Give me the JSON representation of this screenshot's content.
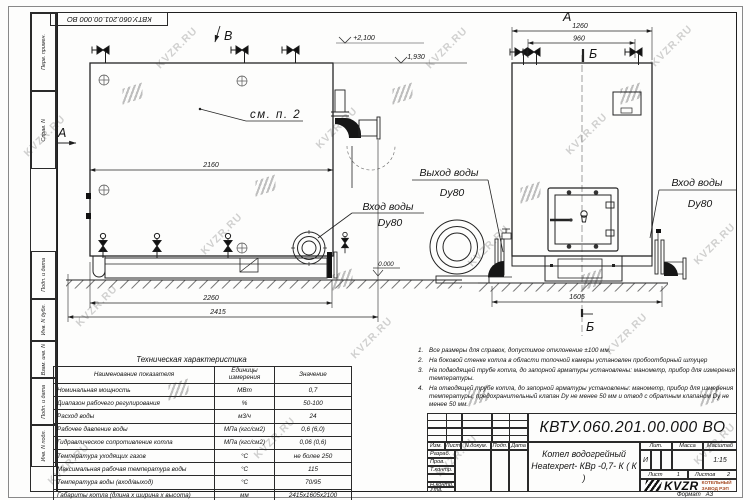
{
  "watermark": {
    "text": "KVZR.RU"
  },
  "frame": {
    "corner_designation": "КВТУ.060.201.00.000  ВО",
    "left_strip": [
      "Перв. примен.",
      "Справ. N",
      "Подп. и дата",
      "Инв. N дубл.",
      "Взам. инв. N",
      "Подп. и дата",
      "Инв. N подл."
    ]
  },
  "drawing": {
    "view_labels": {
      "a": "А",
      "b": "Б",
      "v": "В"
    },
    "callout_see_item": "см. п. 2",
    "levels": {
      "top": "+2,100",
      "middle": "1,930",
      "zero": "0.000"
    },
    "dims": {
      "body_width": "2160",
      "base_width": "2260",
      "total_width": "2415",
      "front_width": "1260",
      "valve_spacing": "960",
      "front_depth": "1605"
    },
    "ports": {
      "inlet": "Вход воды",
      "outlet": "Выход воды",
      "dn": "Dy80"
    }
  },
  "tech_table": {
    "title": "Техническая характеристика",
    "headers": [
      "Наименование показателя",
      "Единицы измерения",
      "Значение"
    ],
    "rows": [
      [
        "Номинальная мощность",
        "МВт",
        "0,7"
      ],
      [
        "Диапазон рабочего регулирования",
        "%",
        "50-100"
      ],
      [
        "Расход воды",
        "м3/ч",
        "24"
      ],
      [
        "Рабочее давление воды",
        "МПа (кгс/см2)",
        "0,6 (6,0)"
      ],
      [
        "Гидравлическое сопротивление котла",
        "МПа (кгс/см2)",
        "0,06 (0,6)"
      ],
      [
        "Температура уходящих газов",
        "°С",
        "не более 250"
      ],
      [
        "Максимальная рабочая температура воды",
        "°С",
        "115"
      ],
      [
        "Температура воды (вход/выход)",
        "°С",
        "70/95"
      ],
      [
        "Габариты котла (длина х ширина х высота)",
        "мм",
        "2415х1605х2100"
      ]
    ]
  },
  "notes": {
    "items": [
      {
        "num": "1.",
        "text": "Все размеры для справок, допустимое отклонение  ±100 мм."
      },
      {
        "num": "2.",
        "text": "На боковой стенке котла в области топочной камеры установлен пробоотборный штуцер"
      },
      {
        "num": "3.",
        "text": "На  подводящей трубе котла, до запорной арматуры установлены: манометр, прибор для измерения температуры."
      },
      {
        "num": "4.",
        "text": "На отводящей трубе котла, до запорной арматуры установлены: манометр, прибор для измерения температуры, предохранительный клапан Dу не менее 50 мм и отвод с обратным клапаном Dу не менее 50 мм."
      }
    ]
  },
  "title_block": {
    "designation": "КВТУ.060.201.00.000  ВО",
    "doc_name_line1": "Котел водогрейный",
    "doc_name_line2": "Heatexpert- КВр -0,7- К ( К )",
    "rev_headers": [
      "Изм.",
      "Лист",
      "N докум.",
      "Подп.",
      "Дата"
    ],
    "sig_rows": [
      "Разраб.",
      "Пров.",
      "Т.контр.",
      "Н.контр.",
      "Утв."
    ],
    "lit_label": "Лит.",
    "mass_label": "Масса",
    "scale_label": "Масштаб",
    "lit_value": "И",
    "scale_value": "1:15",
    "sheet_label": "Лист",
    "sheet_value": "1",
    "sheets_label": "Листов",
    "sheets_value": "2",
    "company_name": "KVZR",
    "company_sub1": "КОТЕЛЬНЫЙ",
    "company_sub2": "ЗАВОД  РЭП",
    "format_label": "Формат",
    "format_value": "А3"
  }
}
